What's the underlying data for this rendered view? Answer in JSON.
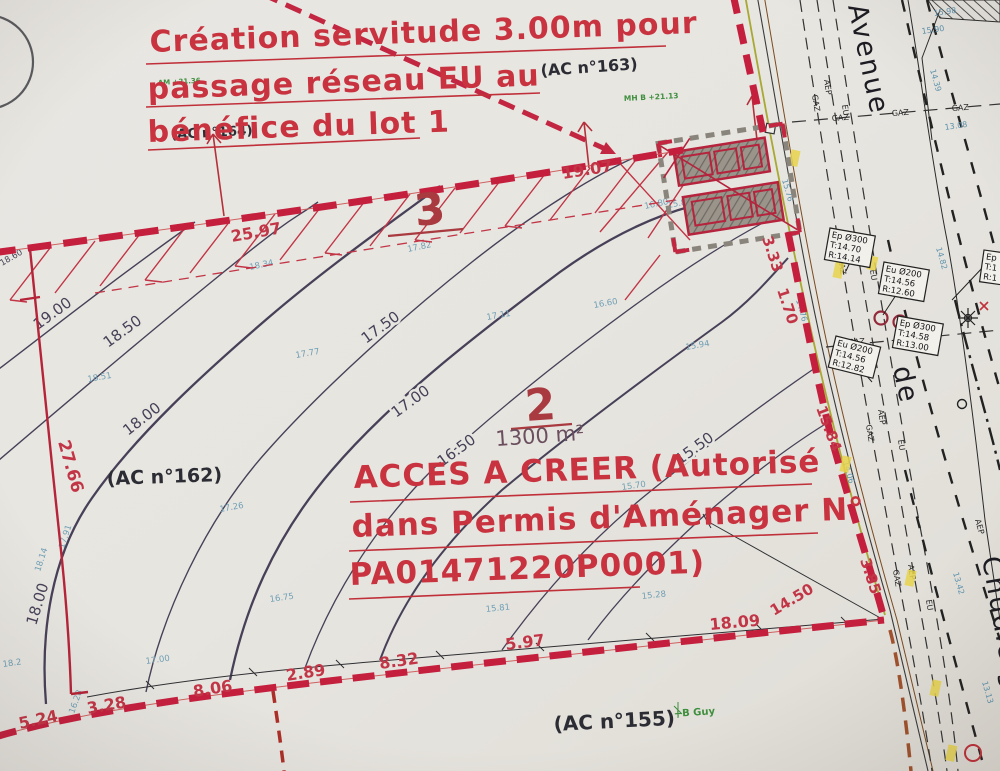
{
  "annotations": {
    "servitude": {
      "line1": "Création servitude 3.00m pour",
      "line2": "passage réseau EU au",
      "line3": "bénéfice du lot 1"
    },
    "access": {
      "line1": "ACCES A CREER (Autorisé",
      "line2": "dans Permis d'Aménager N°",
      "line3": "PA01471220P0001)"
    }
  },
  "cadastre": {
    "ac163": "(AC n°163)",
    "ac164": "(AC n°164)",
    "ac162": "(AC n°162)",
    "ac155": "(AC n°155)"
  },
  "parcels": {
    "lot3": {
      "number": "3"
    },
    "lot2": {
      "number": "2",
      "area": "1300 m²"
    }
  },
  "measurements": {
    "top": [
      "25.97",
      "19.07"
    ],
    "right": [
      "3.33",
      "1.70",
      "15.84",
      "3.85"
    ],
    "bottom": [
      "5.24",
      "3.28",
      "8.06",
      "2.89",
      "8.32",
      "5.97",
      "18.09",
      "14.50"
    ],
    "left": [
      "27.66"
    ]
  },
  "contours": {
    "labels": [
      "19.00",
      "18.50",
      "18.00",
      "17.50",
      "17.00",
      "16.50",
      "15.50"
    ]
  },
  "spot_heights": [
    "18.60",
    "18.51",
    "18.34",
    "17.82",
    "16.80",
    "17.77",
    "17.91",
    "18.14",
    "17.26",
    "17.11",
    "16.60",
    "15.94",
    "15.70",
    "16.75",
    "17.00",
    "16.28",
    "15.81",
    "15.28",
    "15.80",
    "18.2"
  ],
  "street": {
    "avenue": "Avenue",
    "de": "de",
    "chudleigh": "Chudleigh"
  },
  "road_labels": {
    "gaz": "GAZ",
    "aep": "AEP",
    "eu": "EU"
  },
  "road_levels": [
    "15.98",
    "15.90",
    "14.39",
    "13.08",
    "15.76",
    "14.76",
    "14.06",
    "13.42",
    "13.13",
    "14.82"
  ],
  "utility_boxes": [
    {
      "l1": "Ep Ø300",
      "l2": "T:14.70",
      "l3": "R:14.14"
    },
    {
      "l1": "Eu Ø200",
      "l2": "T:14.56",
      "l3": "R:12.60"
    },
    {
      "l1": "Ep Ø300",
      "l2": "T:14.58",
      "l3": "R:13.00"
    },
    {
      "l1": "Eu Ø200",
      "l2": "T:14.56",
      "l3": "R:12.82"
    },
    {
      "l1": "Ep",
      "l2": "T:1",
      "l3": "R:1"
    }
  ],
  "green_notes": {
    "guy": "+B Guy",
    "mh": "MH B +21.13",
    "am": "AM +21.36"
  },
  "colors": {
    "boundary_red": "#c51f3e",
    "annotation_red": "#c8333f",
    "contour_purple": "#474058",
    "spot_blue": "#6f9fb5",
    "paper": "#e7e5e0"
  }
}
